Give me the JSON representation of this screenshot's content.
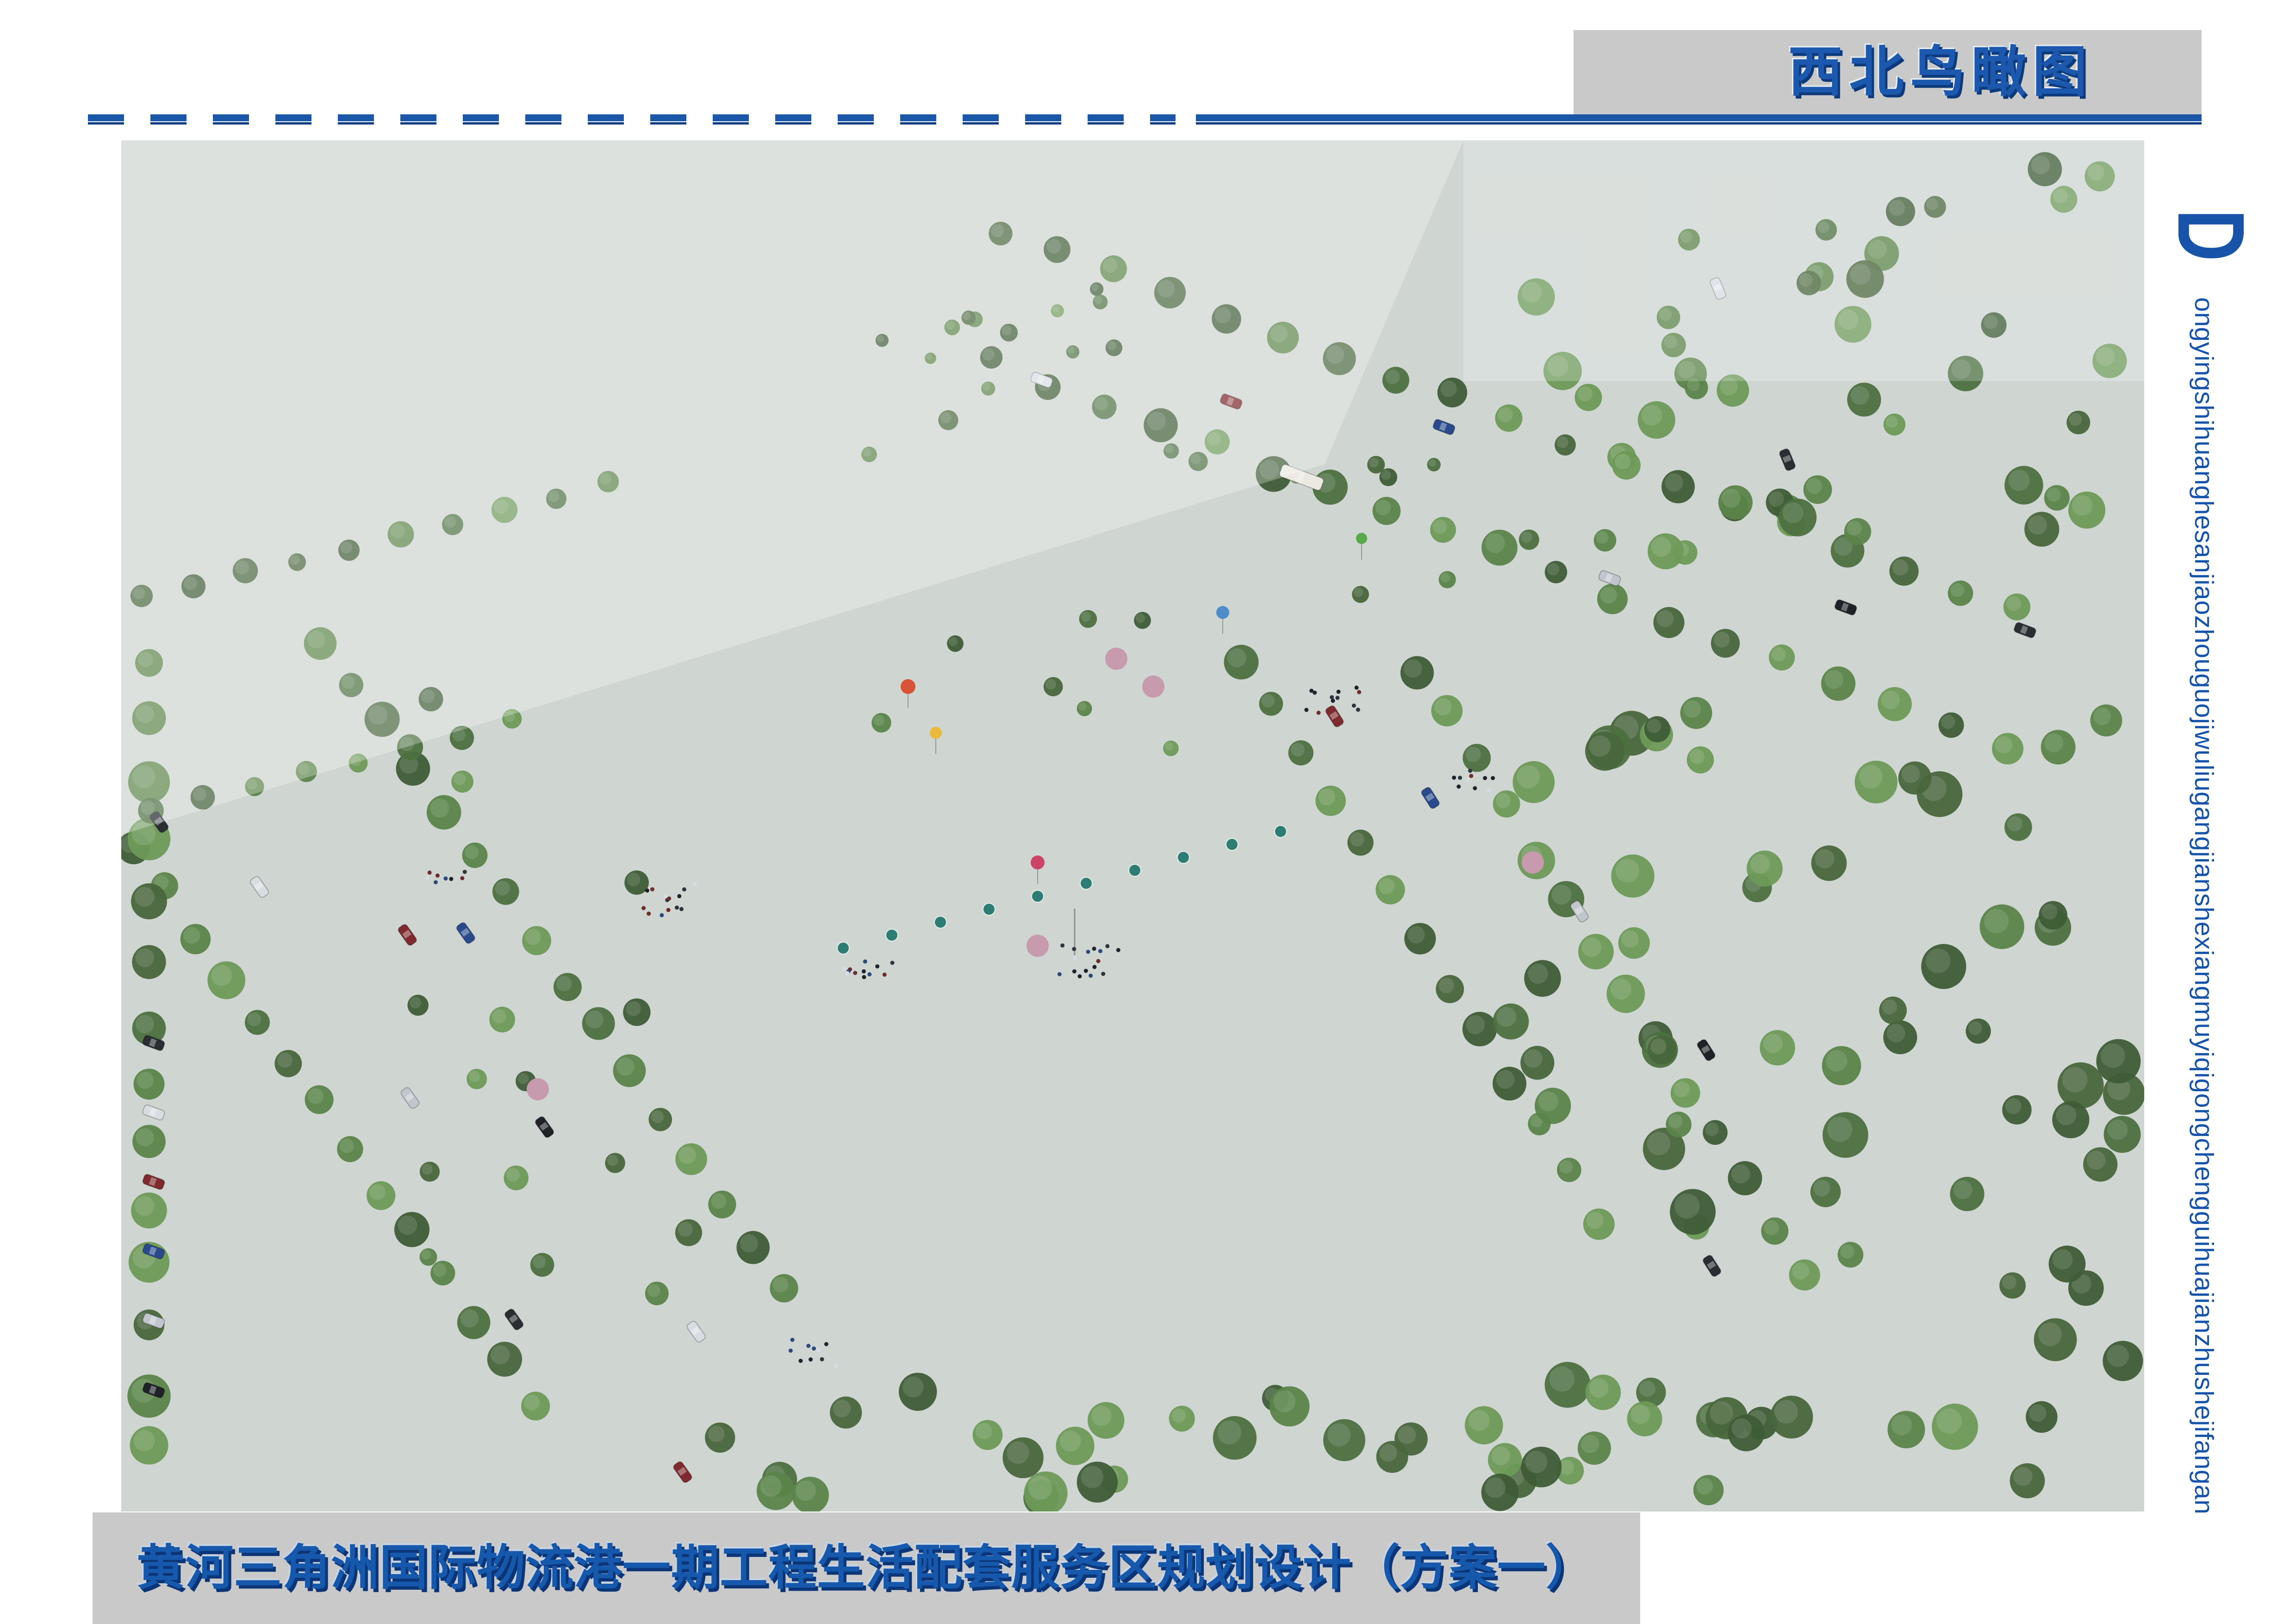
{
  "header": {
    "view_label": "西北鸟瞰图",
    "rule_color": "#1B57A9",
    "rule_dark_color": "#0D3D7F",
    "panel_color": "#C9C9C9"
  },
  "footer": {
    "title": "黄河三角洲国际物流港一期工程生活配套服务区规划设计（方案一）"
  },
  "side_caption": {
    "initial": "D",
    "pinyin": "ongyingshihuanghesanjiaozhouguojiwuliugangjianshexiangmuyiqigongchengguihuajianzhushejifangan",
    "color": "#1753A8"
  },
  "rendering": {
    "signage": [
      "GUCCI",
      "HERMES",
      "MOET & CHANDON",
      "DOUBLE J",
      "ROLEX",
      "FENDI"
    ]
  },
  "colors": {
    "accent_blue": "#1B57A9",
    "navy_shadow": "#0D3D7F",
    "panel_gray": "#C9C9C9"
  }
}
